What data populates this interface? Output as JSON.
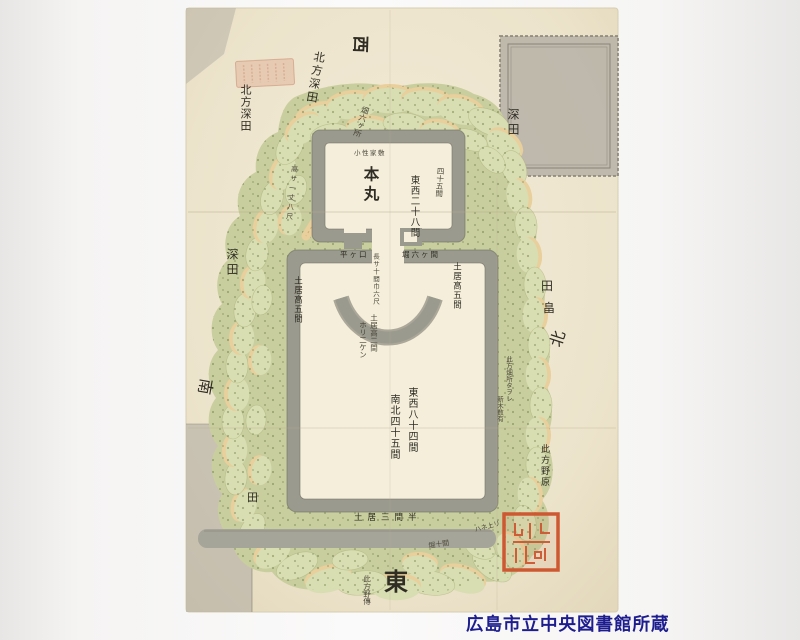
{
  "palette": {
    "paper": "#ece3cb",
    "paper_light": "#f3ecd8",
    "paper_edge": "#d8cdb0",
    "interior": "#f4eedb",
    "wall": "#9b9a8e",
    "wall_dark": "#6f6f62",
    "green": "#c9ce9e",
    "green_light": "#d9ddb2",
    "green_line": "#a8b177",
    "dots": "#6c7c49",
    "tan": "#e8cf9b",
    "tan_edge": "#caa368",
    "moat": "#a6a599",
    "patch": "#b3aea4",
    "patch_line": "#8a8478",
    "seal_red": "#cd5832",
    "seal_faded": "#d8907466",
    "caption": "#1d1d8f",
    "ink": "#2f2d24",
    "ink_light": "#4a473a",
    "crease": "#b9ad90"
  },
  "compass": {
    "top": "西",
    "bottom": "東",
    "left": "南",
    "right": "北"
  },
  "labels": {
    "kitakata_fukada_1": "北方深田",
    "kitakata_fukada_2": "北方深田",
    "fukada_right": "深田",
    "fukada_left": "深田",
    "ta_right": "田",
    "hatake_right": "畠",
    "ta_bottom_left": "田",
    "honmaru": "本丸",
    "tozai_28": "東西二十八間",
    "naname_45": "四十五間",
    "hatake_6": "畑六ヶ所",
    "yashiki": "小性家敷",
    "takasa": "高サ一丈八尺",
    "gate_left": "平ヶ口",
    "gate_right": "堀六ヶ間",
    "gate_note": "長サ十間巾六尺",
    "doi_5_left": "土居高五間",
    "doi_5_right": "土居高五間",
    "doi_2": "土居高二間",
    "hori_2": "ホリ二ケン",
    "tozai_84": "東西八十四間",
    "nanboku_45": "南北四十五間",
    "hata_note_1": "此方畑所タヲレ",
    "hata_note_2": "新木数有",
    "nohara_right": "此方野原",
    "nohara_bottom": "此方野傳",
    "doi_3_han": "土居三間半",
    "hori_10": "堀十間",
    "hane_agari": "ハネ上リ"
  },
  "caption": {
    "credit": "広島市立中央図書館所蔵"
  }
}
